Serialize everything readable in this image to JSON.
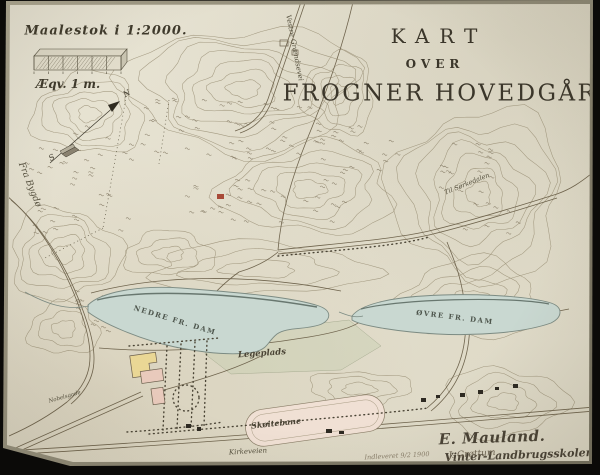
{
  "map": {
    "title": {
      "kart": "KART",
      "over": "OVER",
      "name": "FROGNER HOVEDGÅRD."
    },
    "scale": {
      "maalestok": "Maalestok i 1:2000.",
      "aeqv": "Æqv. 1 m."
    },
    "compass": {
      "n": "N",
      "s": "S"
    },
    "roads": {
      "fra_bygdo": "Fra Bygdø",
      "vestre_graendsevei": "Vestre Grændsevei",
      "til_sorkedalen": "Til Sørkedalen",
      "kirkeveien": "Kirkeveien",
      "nobelsgade": "Nobelsgade"
    },
    "water": {
      "nedre_dam": "NEDRE FR. DAM",
      "ovre_dam": "ØVRE FR. DAM"
    },
    "places": {
      "legeplads": "Legeplads",
      "skoitebane": "Skøitebane"
    },
    "credits": {
      "author": "E. Mauland.",
      "school": "Vinter-Landbrugsskolen.",
      "note": "Indleveret 9/2 1900",
      "note_sig": "J. Grøttum"
    },
    "colors": {
      "paper": "#e5e1d1",
      "ink": "#46402f",
      "contour": "#8f8469",
      "water": "#c9d8d1",
      "rink": "#f0e0d4",
      "building_yellow": "#ead795",
      "building_pink": "#e9cabc"
    }
  }
}
